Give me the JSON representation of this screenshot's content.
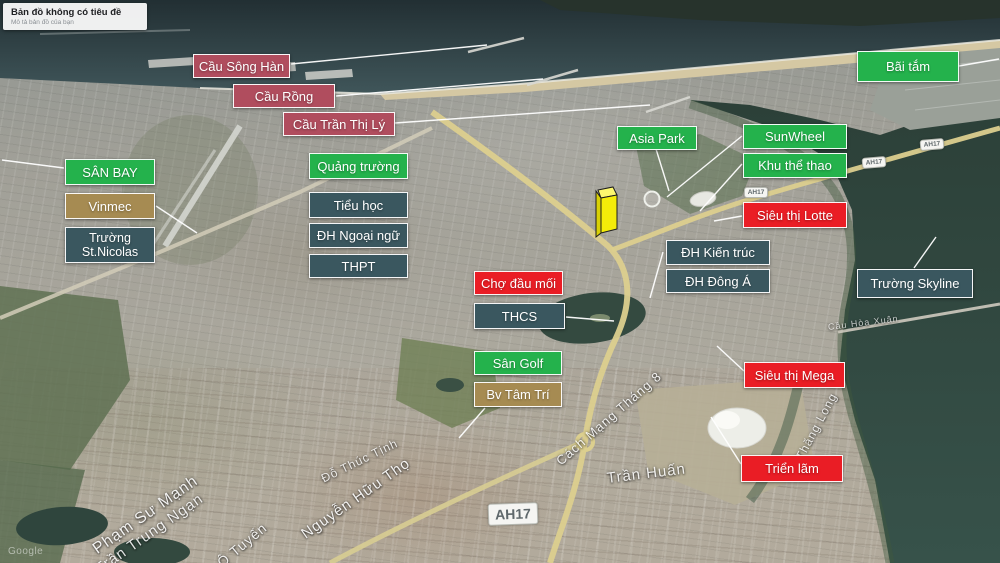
{
  "map_card": {
    "title": "Bản đồ không có tiêu đề",
    "subtitle": "Mô tả bản đồ của bạn"
  },
  "watermark": "Google",
  "palette": {
    "green": "#24b24c",
    "red": "#ea1d25",
    "rose": "#b04d5e",
    "teal": "#3a575f",
    "tan": "#a68b52",
    "highlight_building": "#f4ec09"
  },
  "place_labels": [
    {
      "name": "label-cau-song-han",
      "text": "Cầu Sông Hàn",
      "variant": "rose",
      "x": 193,
      "y": 54,
      "w": 97,
      "h": 24
    },
    {
      "name": "label-cau-rong",
      "text": "Cầu Rồng",
      "variant": "rose",
      "x": 233,
      "y": 84,
      "w": 102,
      "h": 24
    },
    {
      "name": "label-cau-tran-thi-ly",
      "text": "Cầu Trần Thị Lý",
      "variant": "rose",
      "x": 283,
      "y": 112,
      "w": 112,
      "h": 24
    },
    {
      "name": "label-san-bay",
      "text": "SÂN BAY",
      "variant": "green",
      "x": 65,
      "y": 159,
      "w": 90,
      "h": 26
    },
    {
      "name": "label-vinmec",
      "text": "Vinmec",
      "variant": "tan",
      "x": 65,
      "y": 193,
      "w": 90,
      "h": 26
    },
    {
      "name": "label-truong-st-nicolas",
      "text": "Trường St.Nicolas",
      "variant": "teal",
      "x": 65,
      "y": 227,
      "w": 90,
      "h": 36,
      "wrap": true
    },
    {
      "name": "label-quang-truong",
      "text": "Quảng trường",
      "variant": "green",
      "x": 309,
      "y": 153,
      "w": 99,
      "h": 26
    },
    {
      "name": "label-tieu-hoc",
      "text": "Tiểu học",
      "variant": "teal",
      "x": 309,
      "y": 192,
      "w": 99,
      "h": 26
    },
    {
      "name": "label-dh-ngoai-ngu",
      "text": "ĐH Ngoại ngữ",
      "variant": "teal",
      "x": 309,
      "y": 223,
      "w": 99,
      "h": 25
    },
    {
      "name": "label-thpt",
      "text": "THPT",
      "variant": "teal",
      "x": 309,
      "y": 254,
      "w": 99,
      "h": 24
    },
    {
      "name": "label-asia-park",
      "text": "Asia Park",
      "variant": "green",
      "x": 617,
      "y": 126,
      "w": 80,
      "h": 24
    },
    {
      "name": "label-sunwheel",
      "text": "SunWheel",
      "variant": "green",
      "x": 743,
      "y": 124,
      "w": 104,
      "h": 25
    },
    {
      "name": "label-khu-the-thao",
      "text": "Khu thể thao",
      "variant": "green",
      "x": 743,
      "y": 153,
      "w": 104,
      "h": 25
    },
    {
      "name": "label-bai-tam",
      "text": "Bãi tắm",
      "variant": "green",
      "x": 857,
      "y": 51,
      "w": 102,
      "h": 31
    },
    {
      "name": "label-sieu-thi-lotte",
      "text": "Siêu thị Lotte",
      "variant": "red",
      "x": 743,
      "y": 202,
      "w": 104,
      "h": 26
    },
    {
      "name": "label-dh-kien-truc",
      "text": "ĐH Kiến trúc",
      "variant": "teal",
      "x": 666,
      "y": 240,
      "w": 104,
      "h": 25
    },
    {
      "name": "label-dh-dong-a",
      "text": "ĐH Đông Á",
      "variant": "teal",
      "x": 666,
      "y": 269,
      "w": 104,
      "h": 24
    },
    {
      "name": "label-cho-dau-moi",
      "text": "Chợ đầu mối",
      "variant": "red",
      "x": 474,
      "y": 271,
      "w": 89,
      "h": 24
    },
    {
      "name": "label-thcs",
      "text": "THCS",
      "variant": "teal",
      "x": 474,
      "y": 303,
      "w": 91,
      "h": 26
    },
    {
      "name": "label-truong-skyline",
      "text": "Trường Skyline",
      "variant": "teal",
      "x": 857,
      "y": 269,
      "w": 116,
      "h": 29
    },
    {
      "name": "label-san-golf",
      "text": "Sân Golf",
      "variant": "green",
      "x": 474,
      "y": 351,
      "w": 88,
      "h": 24
    },
    {
      "name": "label-bv-tam-tri",
      "text": "Bv Tâm Trí",
      "variant": "tan",
      "x": 474,
      "y": 382,
      "w": 88,
      "h": 25
    },
    {
      "name": "label-sieu-thi-mega",
      "text": "Siêu thị Mega",
      "variant": "red",
      "x": 744,
      "y": 362,
      "w": 101,
      "h": 26
    },
    {
      "name": "label-trien-lam",
      "text": "Triển lãm",
      "variant": "red",
      "x": 741,
      "y": 455,
      "w": 102,
      "h": 27
    }
  ],
  "road_shields": [
    {
      "text": "AH17",
      "x": 488,
      "y": 503,
      "w": 50,
      "h": 22,
      "rot": -2,
      "size": 14
    },
    {
      "text": "AH17",
      "x": 744,
      "y": 187,
      "w": 24,
      "h": 11,
      "rot": 0,
      "size": 6.5
    },
    {
      "text": "AH17",
      "x": 862,
      "y": 157,
      "w": 24,
      "h": 11,
      "rot": -5,
      "size": 6.5
    },
    {
      "text": "AH17",
      "x": 920,
      "y": 139,
      "w": 24,
      "h": 11,
      "rot": -5,
      "size": 6.5
    }
  ],
  "street_names": [
    {
      "text": "Phạm Sư Mạnh",
      "x": 95,
      "y": 542,
      "rot": -35,
      "size": 16,
      "op": 0.95
    },
    {
      "text": "Trần Trung Ngạn",
      "x": 97,
      "y": 562,
      "rot": -35,
      "size": 15,
      "op": 0.9
    },
    {
      "text": "Ô Tuyến",
      "x": 219,
      "y": 556,
      "rot": -40,
      "size": 14,
      "op": 0.9
    },
    {
      "text": "Nguyễn Hữu Thọ",
      "x": 303,
      "y": 527,
      "rot": -35,
      "size": 15,
      "op": 0.95
    },
    {
      "text": "Đỗ Thúc Tịnh",
      "x": 322,
      "y": 472,
      "rot": -26,
      "size": 12,
      "op": 0.85
    },
    {
      "text": "Cách Mạng Tháng 8",
      "x": 558,
      "y": 455,
      "rot": -41,
      "size": 13,
      "op": 0.9
    },
    {
      "text": "Trần Huấn",
      "x": 607,
      "y": 470,
      "rot": -7,
      "size": 15,
      "op": 0.9
    },
    {
      "text": "Thăng Long",
      "x": 799,
      "y": 452,
      "rot": -62,
      "size": 12,
      "op": 0.85
    },
    {
      "text": "Cầu Hòa Xuân",
      "x": 828,
      "y": 322,
      "rot": -7,
      "size": 9,
      "op": 0.75
    }
  ]
}
